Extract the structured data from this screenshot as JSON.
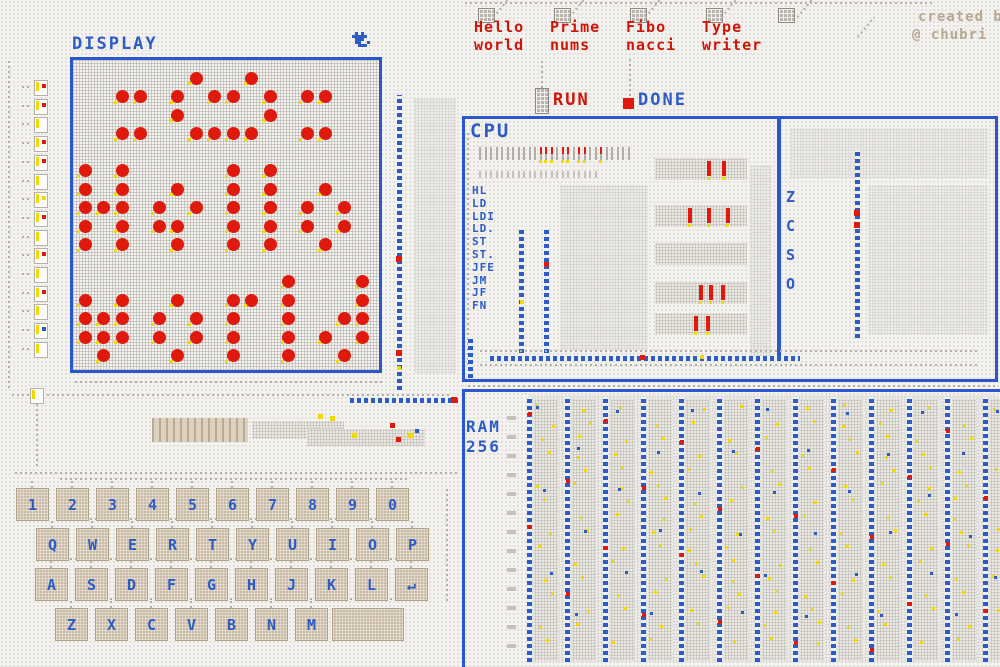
{
  "credit": {
    "line1": "created b",
    "line2": "@ chubri"
  },
  "programs": {
    "items": [
      {
        "line1": "Hello",
        "line2": "world"
      },
      {
        "line1": "Prime",
        "line2": "nums"
      },
      {
        "line1": "Fibo",
        "line2": "nacci"
      },
      {
        "line1": "Type",
        "line2": "writer"
      }
    ],
    "run_label": "RUN",
    "done_label": "DONE"
  },
  "display": {
    "title": "DISPLAY",
    "rows": 16,
    "cols": 16,
    "matrix": [
      "......X..X......",
      "..XX.X.XX.X.XX..",
      ".....X....X.....",
      "..XX..XXXX..XX..",
      "................",
      "X.X.....X.X.....",
      "X.X..X..X.X..X..",
      "XXX.X.X.X.X.X.X.",
      "X.X.XX..X.X.X.X.",
      "X.X..X..X.X..X..",
      "................",
      "...........X...X",
      "X.X..X..XX.X...X",
      "XXX.X.X.X..X..XX",
      "XXX.X.X.X..X.X.X",
      ".X...X..X..X..X."
    ]
  },
  "cpu": {
    "title": "CPU",
    "instructions": [
      "HL",
      "LD",
      "LDI",
      "LD.",
      "ST",
      "ST.",
      "JFE",
      "JM",
      "JF",
      "FN"
    ],
    "flags": [
      "Z",
      "C",
      "S",
      "O"
    ]
  },
  "ram": {
    "title_line1": "RAM",
    "title_line2": "256",
    "column_count": 13
  },
  "keyboard": {
    "row1": [
      "1",
      "2",
      "3",
      "4",
      "5",
      "6",
      "7",
      "8",
      "9",
      "0"
    ],
    "row2": [
      "Q",
      "W",
      "E",
      "R",
      "T",
      "Y",
      "U",
      "I",
      "O",
      "P"
    ],
    "row3": [
      "A",
      "S",
      "D",
      "F",
      "G",
      "H",
      "J",
      "K",
      "L",
      "↵"
    ],
    "row4": [
      "Z",
      "X",
      "C",
      "V",
      "B",
      "N",
      "M"
    ],
    "space_label": ""
  },
  "colors": {
    "wire_blue": "#2e5cc7",
    "signal_red": "#df1a0c",
    "text_red": "#cf1507",
    "pin_yellow": "#f0da00",
    "key_tan": "#c9bba5",
    "credit_tan": "#b9a890"
  }
}
